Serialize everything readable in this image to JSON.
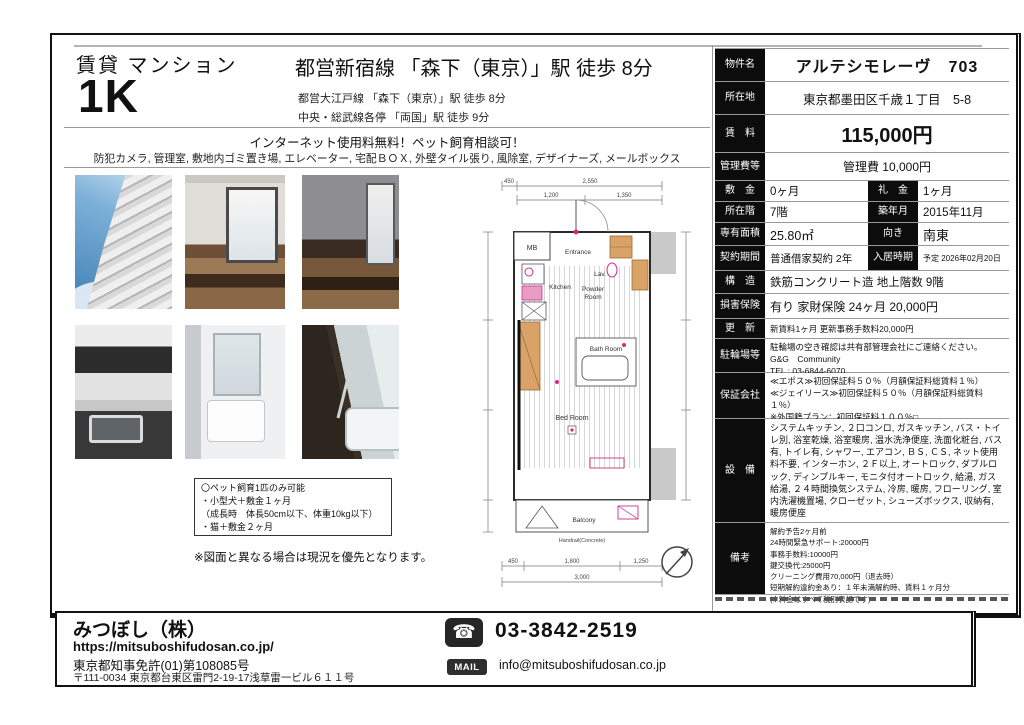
{
  "header": {
    "category": "賃貸 マンション",
    "layout": "1K",
    "main_station": "都営新宿線 「森下（東京）」駅 徒歩 8分",
    "sub_stations": [
      "都営大江戸線 「森下（東京）」駅 徒歩 8分",
      "中央・総武線各停 「両国」駅 徒歩 9分"
    ],
    "catch_copy": "インターネット使用料無料！ペット飼育相談可！",
    "features": "防犯カメラ, 管理室, 敷地内ゴミ置き場, エレベーター, 宅配ＢＯＸ, 外壁タイル張り, 風除室, デザイナーズ, メールボックス"
  },
  "pet_note": {
    "lines": [
      "〇ペット飼育1匹のみ可能",
      "・小型犬＋敷金１ヶ月",
      "（成長時　体長50cm以下、体重10kg以下）",
      "・猫＋敷金２ヶ月"
    ],
    "disclaimer": "※図面と異なる場合は現況を優先となります。"
  },
  "floorplan": {
    "mb": "MB",
    "entrance": "Entrance",
    "lav": "Lav.",
    "kitchen": "Kitchen",
    "powder_room_1": "Powder",
    "powder_room_2": "Room",
    "bath_room": "Bath Room",
    "bed_room": "Bed Room",
    "balcony": "Balcony",
    "handrail": "Handrail(Concrete)",
    "d450": "450",
    "d2550": "2,550",
    "d1200": "1,200",
    "d1350": "1,350",
    "d1800": "1,800",
    "d1250": "1,250",
    "d3000": "3,000"
  },
  "spec": {
    "property_name_label": "物件名",
    "property_name": "アルテシモレーヴ　703",
    "address_label": "所在地",
    "address": "東京都墨田区千歳１丁目　5-8",
    "rent_label": "賃　料",
    "rent": "115,000円",
    "fee_label": "管理費等",
    "fee": "管理費 10,000円",
    "deposit_label": "敷　金",
    "deposit": "0ヶ月",
    "key_money_label": "礼　金",
    "key_money": "1ヶ月",
    "floor_label": "所在階",
    "floor": "7階",
    "built_label": "築年月",
    "built": "2015年11月",
    "area_label": "専有面積",
    "area": "25.80㎡",
    "facing_label": "向き",
    "facing": "南東",
    "contract_label": "契約期間",
    "contract": "普通借家契約 2年",
    "movein_label": "入居時期",
    "movein": "予定 2026年02月20日",
    "structure_label": "構　造",
    "structure": "鉄筋コンクリート造 地上階数 9階",
    "insurance_label": "損害保険",
    "insurance": "有り 家財保険 24ヶ月 20,000円",
    "renewal_label": "更　新",
    "renewal": "新賃料1ヶ月 更新事務手数料20,000円",
    "bicycle_label": "駐輪場等",
    "bicycle_lines": [
      "駐輪場の空き確認は共有部管理会社にご連絡ください。",
      "G&G　Community",
      "TEL : 03-6844-6070"
    ],
    "guarantor_label": "保証会社",
    "guarantor_lines": [
      "≪エポス≫初回保証料５０％（月額保証料総賃料１％）",
      "≪ジェイリース≫初回保証料５０％（月額保証料総賃料１％）",
      "※外国籍プラン：初回保証料１００％□"
    ],
    "equipment_label": "設　備",
    "equipment": "システムキッチン, ２口コンロ, ガスキッチン, バス・トイレ別, 浴室乾燥, 浴室暖房, 温水洗浄便座, 洗面化粧台, バス有, トイレ有, シャワー, エアコン, ＢＳ, ＣＳ, ネット使用料不要, インターホン, ２Ｆ以上, オートロック, ダブルロック, ディンプルキー, モニタ付オートロック, 給湯, ガス給湯, ２４時間換気システム, 冷房, 暖房, フローリング, 室内洗濯機置場, クローゼット, シューズボックス, 収納有, 暖房便座",
    "notes_label": "備考",
    "notes_lines": [
      "解約予告2ヶ月前",
      "24時間緊急サポート:20000円",
      "事務手数料:10000円",
      "鍵交換代:25000円",
      "クリーニング費用70,000円（退去時）",
      "短期解約違約金あり：１年未満解約時、賃料１ヶ月分",
      "(※料金はすべて税別表記です)"
    ]
  },
  "footer": {
    "company": "みつぼし（株）",
    "url": "https://mitsuboshifudosan.co.jp/",
    "license": "東京都知事免許(01)第108085号",
    "address": "〒111-0034 東京都台東区雷門2-19-17浅草雷一ビル６１１号",
    "phone": "03-3842-2519",
    "phone_icon": "☎",
    "mail_badge": "MAIL",
    "email": "info@mitsuboshifudosan.co.jp"
  },
  "colors": {
    "accent_black": "#0c0c0c",
    "plan_magenta": "#d6287e",
    "plan_tan": "#d9a267"
  }
}
